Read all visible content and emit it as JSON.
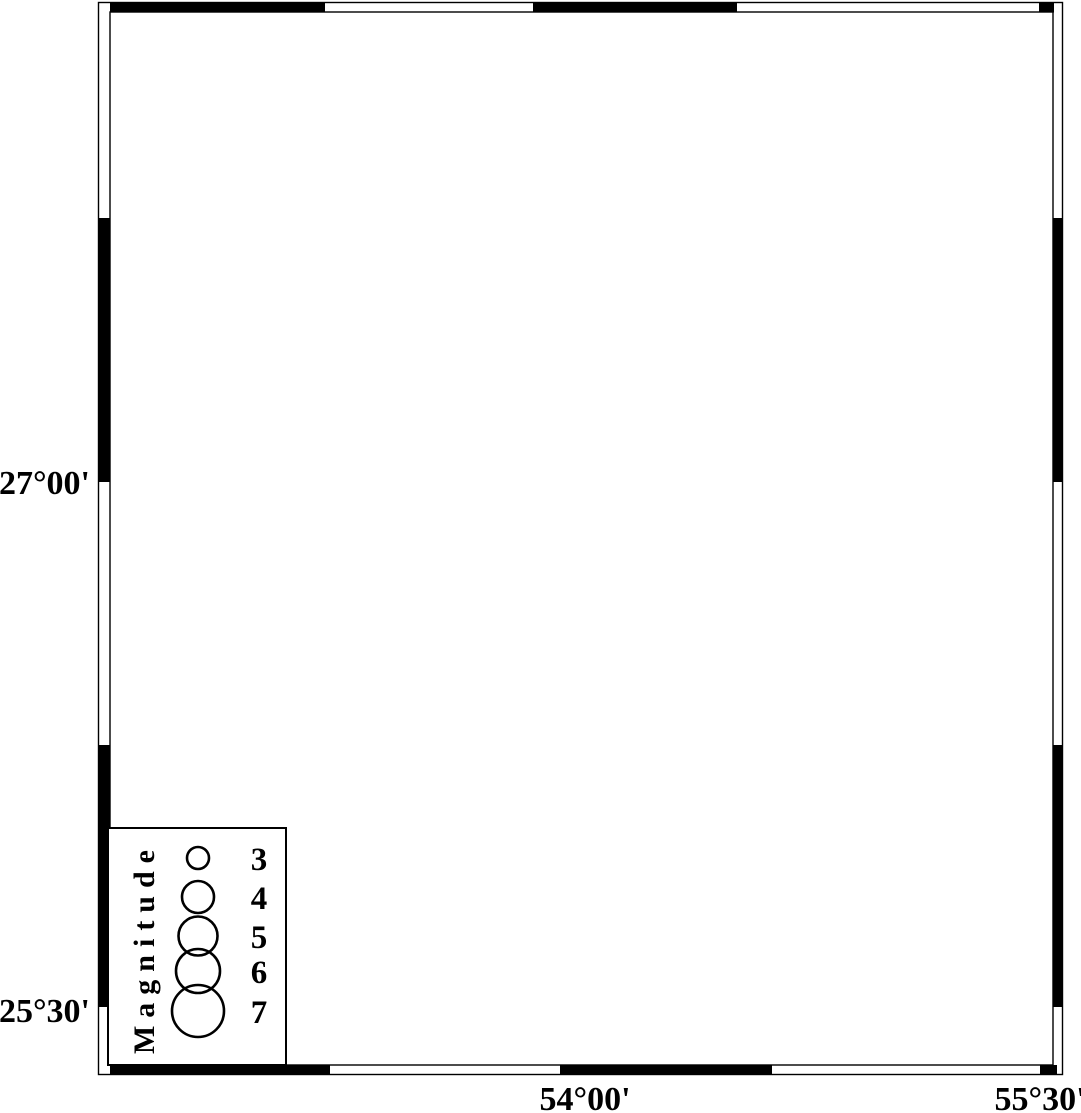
{
  "figure": {
    "type": "seismicity-map",
    "colors": {
      "sea": "#56AEF7",
      "land": "#ffffff",
      "coast": "#16166B",
      "gridline": "#8FC9F9",
      "earthquake_fill": "#FF0000",
      "earthquake_stroke": "#000000",
      "frame": "#000000",
      "station_outer": "#B4B4B4",
      "station_inner": "#000000"
    },
    "scale_bar": {
      "label": "60 km"
    },
    "axes": {
      "lat_labels": [
        {
          "text": "27°00'",
          "x": 90,
          "y": 494
        },
        {
          "text": "25°30'",
          "x": 90,
          "y": 1022
        }
      ],
      "lon_labels": [
        {
          "text": "54°00'",
          "x": 585,
          "y": 1110
        },
        {
          "text": "55°30'",
          "x": 1040,
          "y": 1110
        }
      ]
    },
    "legend": {
      "title": "Magnitude",
      "items": [
        {
          "label": "3",
          "cx": 198,
          "cy": 858,
          "r": 11
        },
        {
          "label": "4",
          "cx": 198,
          "cy": 897,
          "r": 16
        },
        {
          "label": "5",
          "cx": 198,
          "cy": 936,
          "r": 19.5
        },
        {
          "label": "6",
          "cx": 198,
          "cy": 971,
          "r": 22
        },
        {
          "label": "7",
          "cx": 198,
          "cy": 1011,
          "r": 26
        }
      ],
      "number_x": 259
    },
    "earthquakes": [
      {
        "x": 581,
        "y": 542,
        "r": 11
      },
      {
        "x": 621,
        "y": 513,
        "r": 12
      },
      {
        "x": 1015,
        "y": 557,
        "r": 12.5
      }
    ],
    "station_marker": {
      "x": 248,
      "y": 26
    }
  }
}
